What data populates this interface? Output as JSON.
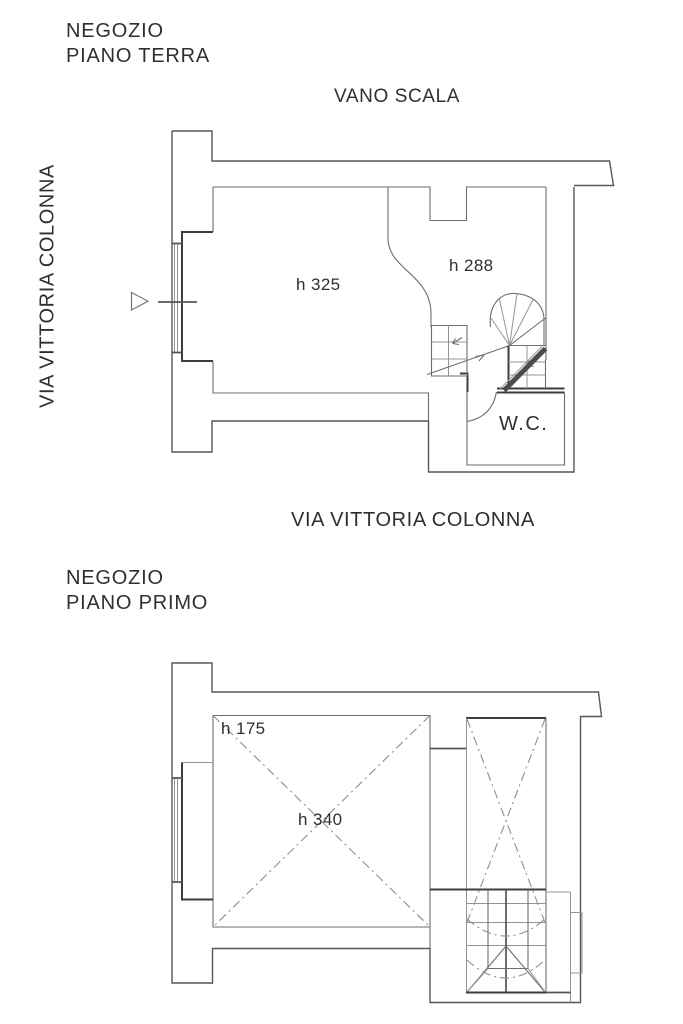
{
  "colors": {
    "background": "#ffffff",
    "line": "#575757",
    "line_dark": "#3d3d3d",
    "text": "#2f2f2f"
  },
  "ground_floor": {
    "title_line1": "NEGOZIO",
    "title_line2": "PIANO TERRA",
    "stairwell_label": "VANO SCALA",
    "street_left": "VIA VITTORIA COLONNA",
    "street_bottom": "VIA VITTORIA COLONNA",
    "height_main_room": "h 325",
    "height_back_room": "h 288",
    "wc": "W.C."
  },
  "first_floor": {
    "title_line1": "NEGOZIO",
    "title_line2": "PIANO PRIMO",
    "height_low_zone": "h 175",
    "height_main_room": "h 340"
  }
}
